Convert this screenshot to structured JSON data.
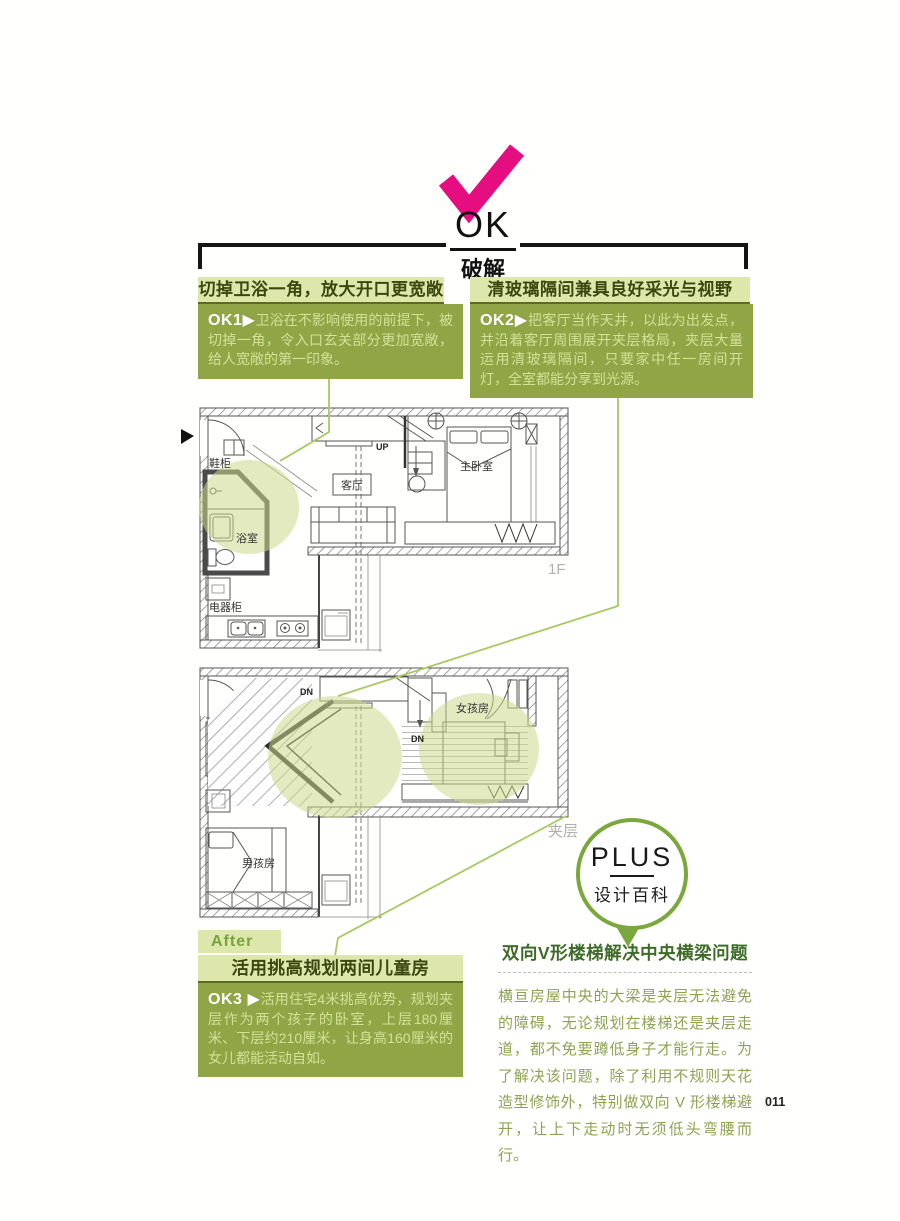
{
  "badge": {
    "ok": "OK",
    "sub": "破解"
  },
  "sections": {
    "ok1": {
      "header": "切掉卫浴一角，放大开口更宽敞",
      "tag": "OK1▶",
      "body": "卫浴在不影响使用的前提下，被切掉一角，令入口玄关部分更加宽敞，给人宽敞的第一印象。"
    },
    "ok2": {
      "header": "清玻璃隔间兼具良好采光与视野",
      "tag": "OK2▶",
      "body": "把客厅当作天井，以此为出发点，并沿着客厅周围展开夹层格局，夹层大量运用清玻璃隔间，只要家中任一房间开灯，全室都能分享到光源。"
    },
    "after_label": "After",
    "ok3": {
      "header": "活用挑高规划两间儿童房",
      "tag": "OK3 ▶",
      "body": "活用住宅4米挑高优势，规划夹层作为两个孩子的卧室，上层180厘米、下层约210厘米，让身高160厘米的女儿都能活动自如。"
    }
  },
  "plus": {
    "title": "PLUS",
    "subtitle": "设计百科",
    "header": "双向V形楼梯解决中央横梁问题",
    "body": "横亘房屋中央的大梁是夹层无法避免的障碍，无论规划在楼梯还是夹层走道，都不免要蹲低身子才能行走。为了解决该问题，除了利用不规则天花造型修饰外，特别做双向 V 形楼梯避开，让上下走动时无须低头弯腰而行。"
  },
  "floorplans": {
    "f1": {
      "caption": "1F",
      "labels": {
        "shoe_cabinet": "鞋柜",
        "bathroom": "浴室",
        "living_room": "客厅",
        "master_bedroom": "主卧室",
        "appliance_cabinet": "电器柜",
        "up": "UP"
      }
    },
    "mezz": {
      "caption": "夹层",
      "labels": {
        "girls_room": "女孩房",
        "boys_room": "男孩房",
        "dn_top": "DN",
        "dn_mid": "DN"
      }
    }
  },
  "page_number": "011",
  "colors": {
    "accent_pink": "#e60d81",
    "block_green": "#8fa546",
    "light_green_bar": "#dde7ab",
    "dark_olive_text": "#3a470f",
    "connector_green": "#a6c961",
    "plus_circle_green": "#7aa83c",
    "highlight_fill": "#ccd98c"
  }
}
